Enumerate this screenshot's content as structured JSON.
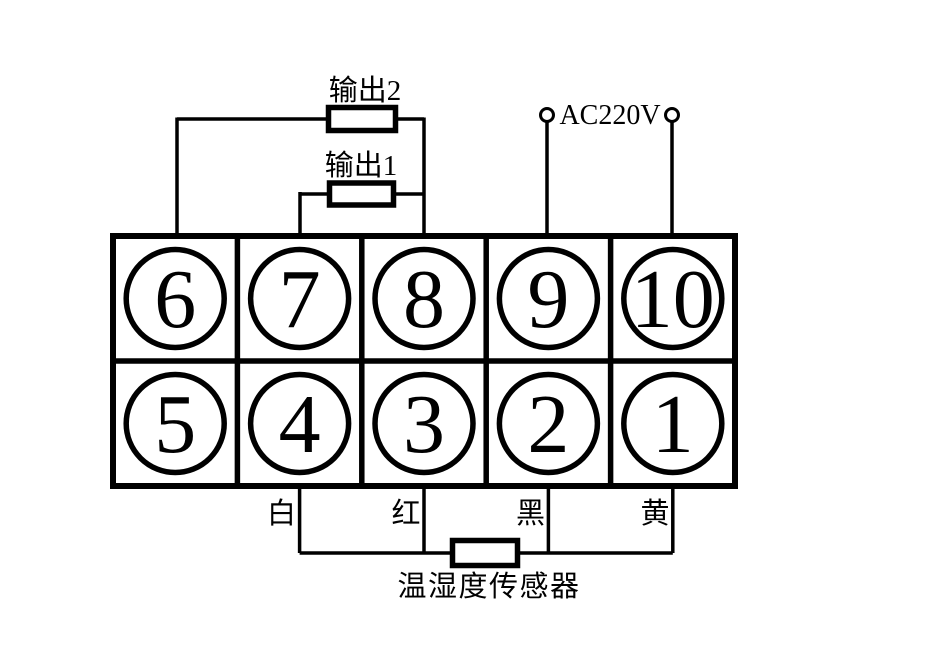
{
  "labels": {
    "output2": "输出2",
    "output1": "输出1",
    "power": "AC220V",
    "sensor": "温湿度传感器"
  },
  "wire_colors": {
    "white": "白",
    "red": "红",
    "black": "黑",
    "yellow": "黄"
  },
  "terminals": {
    "top_row": [
      "6",
      "7",
      "8",
      "9",
      "10"
    ],
    "bottom_row": [
      "5",
      "4",
      "3",
      "2",
      "1"
    ]
  },
  "colors": {
    "line": "#000000",
    "background": "#ffffff"
  }
}
